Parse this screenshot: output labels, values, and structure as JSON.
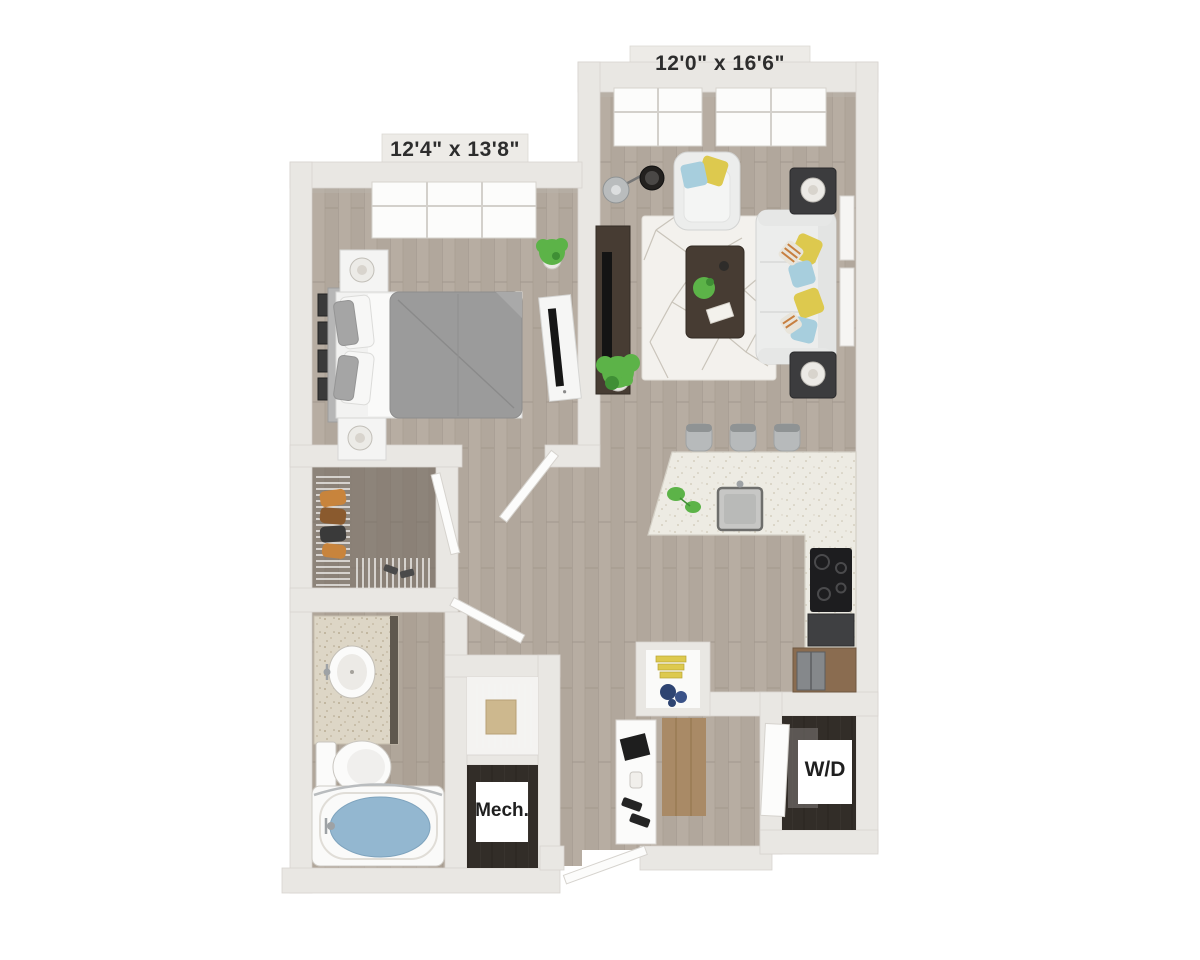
{
  "labels": {
    "living_dimensions": "12'0\" x 16'6\"",
    "bedroom_dimensions": "12'4\" x 13'8\"",
    "washer_dryer": "W/D",
    "mechanical": "Mech."
  },
  "colors": {
    "background": "#ffffff",
    "wall": "#e9e7e3",
    "wall_plate": "#edebe7",
    "floor_wood": "#b7ada2",
    "floor_wood_seam": "#a2988d",
    "bathroom_floor_tint": "#9a8d80",
    "closet_floor": "#6b625a",
    "entry_mat_wood": "#a98a66",
    "utility_floor_dark": "#322d28",
    "label_text": "#2d2d2d",
    "accent_yellow": "#ddc94e",
    "accent_blue": "#a7cedd",
    "accent_stripe_orange": "#c77f3f",
    "plant_green": "#5cb348",
    "plant_green_dark": "#3f8f35",
    "water_blue": "#93b7d0",
    "counter_speckle": "#edebe3",
    "vanity_speckle": "#ddd6c6",
    "rug": "#f3f1ed",
    "rug_line": "#c9c4ba",
    "sofa_white": "#ecedec",
    "bed_duvet_gray": "#9b9b9b",
    "espresso_wood": "#473c33",
    "appliance_black": "#1d1d1f",
    "cabinet_wood": "#8a6c50",
    "stool_gray": "#b7babb",
    "chrome": "#9ea2a5"
  },
  "rooms": [
    {
      "name": "living-room",
      "dimensions": "12'0\" x 16'6\"",
      "furniture": [
        "sofa",
        "armchair",
        "coffee-table",
        "area-rug",
        "media-console",
        "floor-lamp",
        "side-tables",
        "potted-plant",
        "windows"
      ]
    },
    {
      "name": "bedroom",
      "dimensions": "12'4\" x 13'8\"",
      "furniture": [
        "bed",
        "nightstands",
        "lamps",
        "dresser-tv",
        "wall-frames",
        "potted-plant",
        "window"
      ]
    },
    {
      "name": "walk-in-closet",
      "furniture": [
        "wire-shelving",
        "hanging-clothes"
      ]
    },
    {
      "name": "bathroom",
      "furniture": [
        "vanity-sink",
        "toilet",
        "bathtub",
        "shower-rod"
      ]
    },
    {
      "name": "kitchen",
      "furniture": [
        "island-counter",
        "sink",
        "bar-stools",
        "cooktop",
        "dishwasher",
        "refrigerator",
        "pantry-shelves"
      ]
    },
    {
      "name": "laundry-closet",
      "label": "W/D"
    },
    {
      "name": "mechanical-closet",
      "label": "Mech."
    },
    {
      "name": "entry",
      "furniture": [
        "console-table",
        "front-door"
      ]
    }
  ]
}
